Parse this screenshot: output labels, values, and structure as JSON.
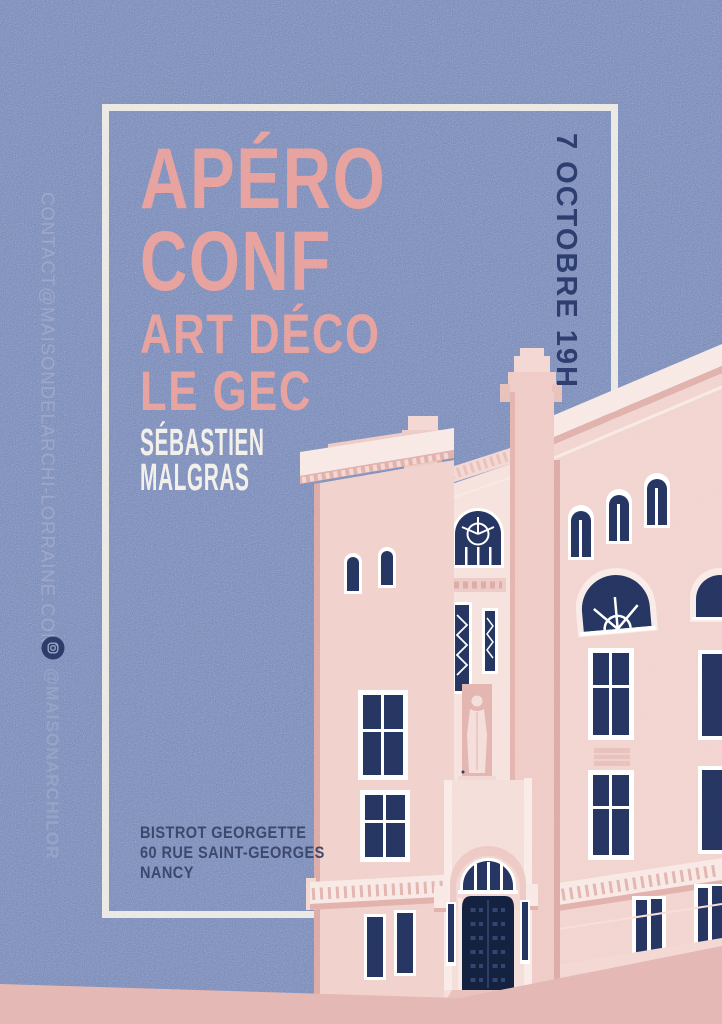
{
  "poster": {
    "title_line1": "APÉRO",
    "title_line2": "CONF",
    "subtitle_line1": "ART DÉCO",
    "subtitle_line2": "LE GEC",
    "speaker_line1": "SÉBASTIEN",
    "speaker_line2": "MALGRAS",
    "date_time": "7 OCTOBRE 19H",
    "contact_email": "CONTACT@MAISONDELARCHI-LORRAINE.COM",
    "instagram_handle": "@MAISONARCHILOR",
    "venue": {
      "name": "BISTROT GEORGETTE",
      "street": "60 RUE SAINT-GEORGES",
      "city": "NANCY"
    }
  },
  "icons": {
    "instagram": "instagram-icon"
  },
  "colors": {
    "background_blue": "#7585b6",
    "accent_pink": "#e7a09c",
    "text_white": "#f3f0ea",
    "text_navy": "#2c3b6b",
    "muted_blue": "#9aa4c6",
    "frame_white": "#ebe9e4",
    "building_light": "#f6e2dd",
    "building_mid": "#f2d4cf",
    "building_shade": "#e9c0bb",
    "window_navy": "#25345f",
    "door_navy": "#13203e",
    "ground_pink": "#e4b6b2"
  }
}
